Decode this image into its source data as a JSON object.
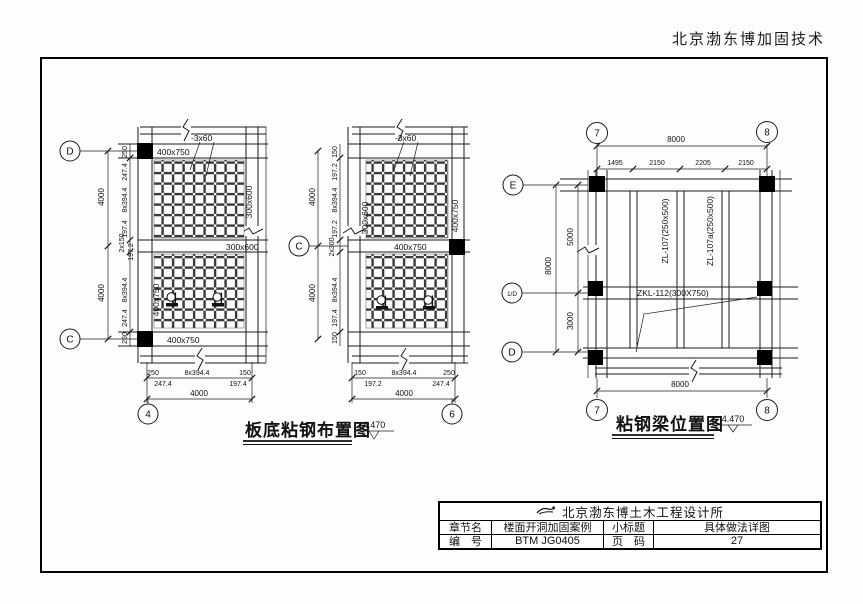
{
  "page": {
    "header_right": "北京渤东博加固技术"
  },
  "titles": {
    "slab_plan": "板底粘钢布置图",
    "beam_plan": "粘钢梁位置图",
    "elevation": "4.470"
  },
  "slab_left": {
    "bubble_top": "D",
    "bubble_bottom": "C",
    "bubble_axis": "4",
    "label_beam_top": "400x750",
    "label_strip": "-3x60",
    "label_beam_right": "300x600",
    "label_beam_mid": "300x600",
    "label_beam_left": "400x750",
    "label_beam_bottom": "400x750",
    "dim_outer_top": "4000",
    "dim_outer_bottom": "4000",
    "dims_inner": [
      "250",
      "247.4",
      "8x394.4",
      "197.4",
      "2x150",
      "197.2",
      "8x394.4",
      "247.4",
      "250"
    ],
    "dims_bottom": [
      "250",
      "8x394.4",
      "150"
    ],
    "dims_bottom2": [
      "247.4",
      "197.4"
    ],
    "dim_bottom_total": "4000"
  },
  "slab_mid": {
    "bubble_left": "C",
    "bubble_axis": "6",
    "label_strip": "-3x60",
    "label_beam_left": "300x600",
    "label_beam_right": "400x750",
    "label_beam_mid": "400x750",
    "dim_outer_top": "4000",
    "dim_outer_bottom": "4000",
    "dims_inner": [
      "150",
      "197.2",
      "8x394.4",
      "197.2",
      "2x300",
      "8x394.4",
      "197.4",
      "150"
    ],
    "dims_bottom": [
      "150",
      "8x394.4",
      "250"
    ],
    "dims_bottom2": [
      "197.2",
      "247.4"
    ],
    "dim_bottom_total": "4000"
  },
  "beam_plan": {
    "bubble_col_left": "7",
    "bubble_col_right": "8",
    "bubble_row_top": "E",
    "bubble_row_mid": "1/D",
    "bubble_row_bottom": "D",
    "dim_top_total": "8000",
    "dims_top": [
      "1495",
      "2150",
      "2205",
      "2150"
    ],
    "dim_left_total": "8000",
    "dim_left_upper": "5000",
    "dim_left_lower": "3000",
    "dim_bottom_total": "8000",
    "label_zl1": "ZL-107(250x500)",
    "label_zl2": "ZL-107a(250x500)",
    "label_zkl": "ZKL-112(300X750)"
  },
  "title_block": {
    "company": "北京渤东博土木工程设计所",
    "logo_icon": "swoosh-boat-logo",
    "chapter_label": "章节名",
    "chapter_value": "楼面开洞加固案例",
    "subtitle_label": "小标题",
    "subtitle_value": "具体做法详图",
    "number_label": "编　号",
    "number_value": "BTM JG0405",
    "page_label": "页　码",
    "page_value": "27"
  },
  "colors": {
    "line": "#1c1c1c",
    "mesh": "#3a3a3a",
    "paper": "#fdfdfd"
  }
}
